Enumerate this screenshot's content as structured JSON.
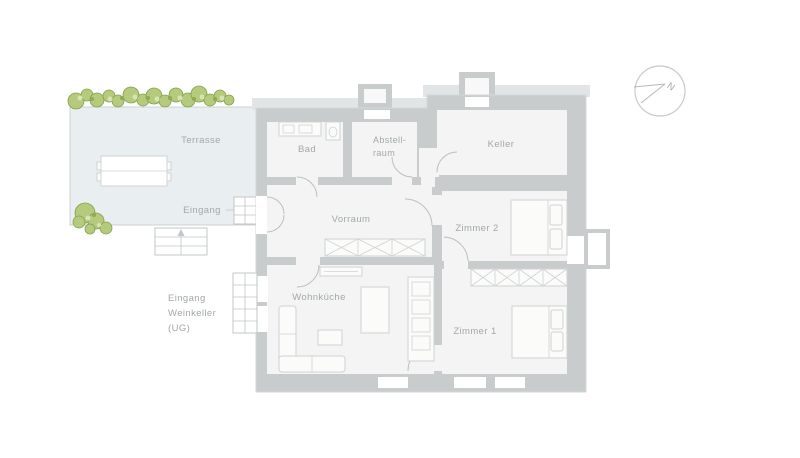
{
  "plan": {
    "type": "floor-plan",
    "labels": {
      "terrasse": "Terrasse",
      "eingang": "Eingang",
      "bad": "Bad",
      "abstellraum_1": "Abstell-",
      "abstellraum_2": "raum",
      "keller": "Keller",
      "vorraum": "Vorraum",
      "zimmer2": "Zimmer 2",
      "zimmer1": "Zimmer 1",
      "wohnkueche": "Wohnküche",
      "weinkeller_1": "Eingang",
      "weinkeller_2": "Weinkeller",
      "weinkeller_3": "(UG)",
      "north": "N"
    },
    "colors": {
      "wall": "#c8cccd",
      "room": "#f3f4f3",
      "terrace": "#e9eef0",
      "tree_green": "#b5ca7c",
      "tree_outline": "#83a04b",
      "label_text": "#a2a8ab",
      "background": "#ffffff"
    }
  }
}
